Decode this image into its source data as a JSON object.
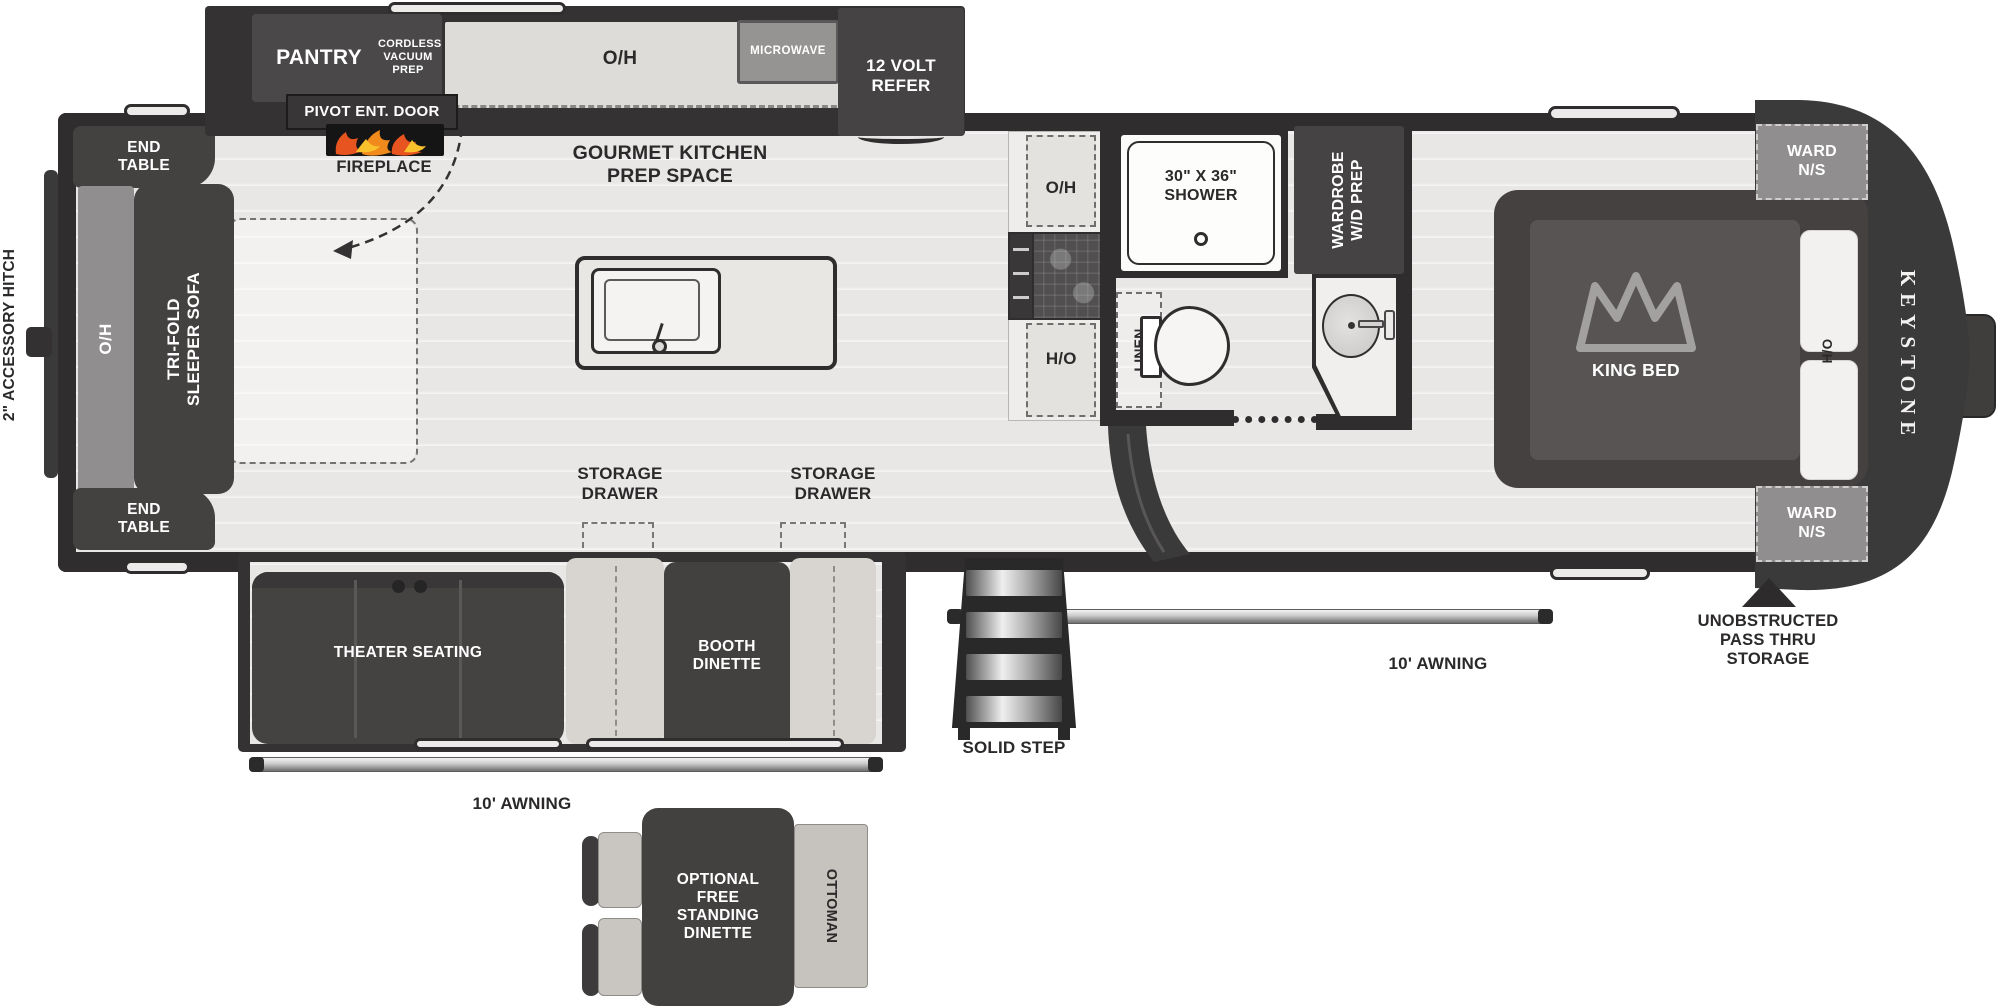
{
  "title": "Fifth Wheel RV Floor Plan",
  "palette": {
    "wall": "#2f2d2d",
    "dark_furniture": "#444141",
    "floor": "#e8e7e6",
    "bench_light": "#d8d5d1",
    "grey_cabinet": "#908e8e",
    "flame_orange": "#f08a1d",
    "flame_red": "#e8541f",
    "flame_yellow": "#fbc12d"
  },
  "labels": {
    "hitch": "2\" ACCESSORY HITCH",
    "end_table_top": "END TABLE",
    "end_table_bottom": "END TABLE",
    "oh_rear": "O/H",
    "sofa": "TRI-FOLD SLEEPER SOFA",
    "pantry": "PANTRY",
    "cordless_vacuum": "CORDLESS VACUUM PREP",
    "oh_kitchen": "O/H",
    "microwave": "MICROWAVE",
    "refer": "12 VOLT REFER",
    "pivot_door": "PIVOT ENT. DOOR",
    "fireplace": "FIREPLACE",
    "gourmet": "GOURMET KITCHEN PREP SPACE",
    "storage_drawer_left": "STORAGE DRAWER",
    "storage_drawer_right": "STORAGE DRAWER",
    "oh_counter_top": "O/H",
    "oh_counter_bottom": "O/H",
    "shower": "30\" X 36\" SHOWER",
    "wardrobe": "WARDROBE W/D PREP",
    "linen": "LINEN",
    "king_bed": "KING BED",
    "ward_top": "WARD N/S",
    "ward_bottom": "WARD N/S",
    "ho": "H/O",
    "brand": "KEYSTONE",
    "theater": "THEATER SEATING",
    "booth": "BOOTH DINETTE",
    "awning_left": "10' AWNING",
    "awning_right": "10' AWNING",
    "solid_step": "SOLID STEP",
    "pass_thru": "UNOBSTRUCTED PASS THRU STORAGE",
    "optional_dinette": "OPTIONAL FREE STANDING DINETTE",
    "ottoman": "OTTOMAN"
  }
}
